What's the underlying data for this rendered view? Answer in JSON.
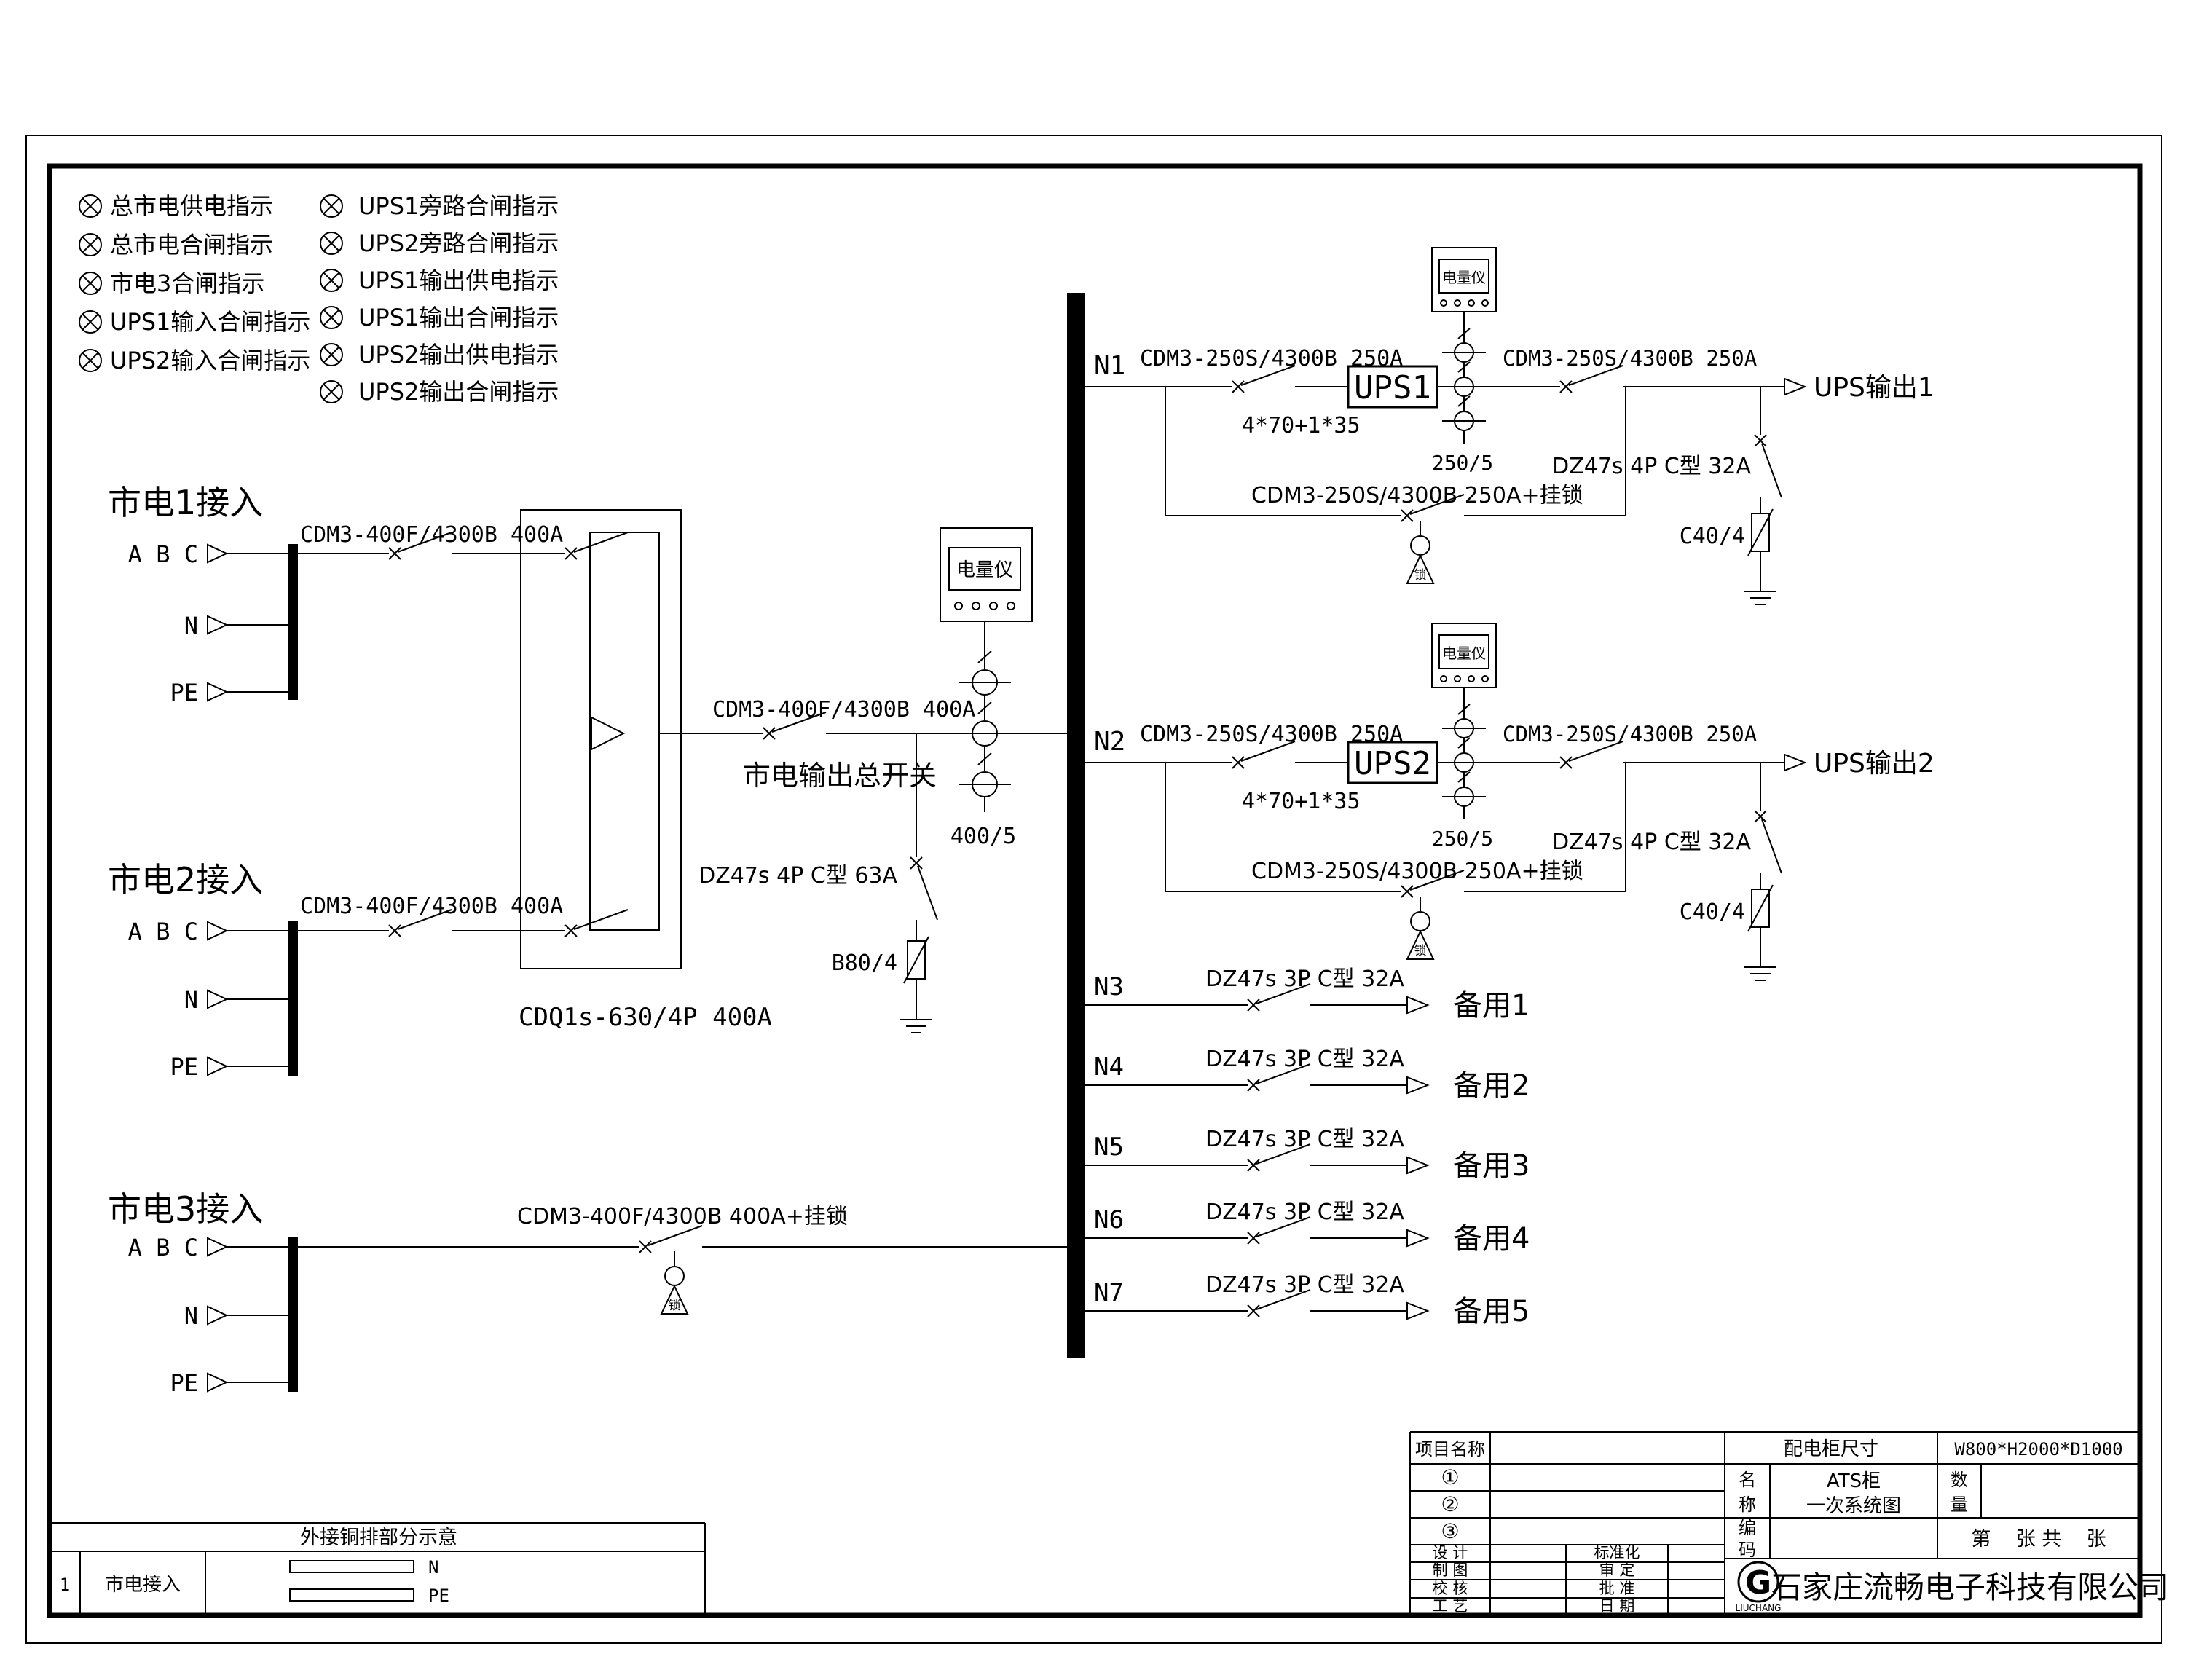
{
  "legend": {
    "items_col1": [
      "总市电供电指示",
      "总市电合闸指示",
      "市电3合闸指示",
      "UPS1输入合闸指示",
      "UPS2输入合闸指示"
    ],
    "items_col2": [
      "UPS1旁路合闸指示",
      "UPS2旁路合闸指示",
      "UPS1输出供电指示",
      "UPS1输出合闸指示",
      "UPS2输出供电指示",
      "UPS2输出合闸指示"
    ]
  },
  "sources": [
    {
      "title": "市电1接入",
      "breaker_label": "CDM3-400F/4300B 400A",
      "terminal_abc": "A B C",
      "terminal_n": "N",
      "terminal_pe": "PE"
    },
    {
      "title": "市电2接入",
      "breaker_label": "CDM3-400F/4300B 400A",
      "terminal_abc": "A B C",
      "terminal_n": "N",
      "terminal_pe": "PE"
    },
    {
      "title": "市电3接入",
      "breaker_label": "CDM3-400F/4300B 400A+挂锁",
      "lock_char": "锁",
      "terminal_abc": "A B C",
      "terminal_n": "N",
      "terminal_pe": "PE"
    }
  ],
  "ats": {
    "model_label": "CDQ1s-630/4P 400A"
  },
  "main_output": {
    "breaker_label": "CDM3-400F/4300B 400A",
    "switch_name": "市电输出总开关",
    "meter_label": "电量仪",
    "ct_ratio": "400/5",
    "spd_breaker_label": "DZ47s 4P C型 63A",
    "spd_label": "B80/4"
  },
  "ups_feeders": [
    {
      "id": "N1",
      "input_breaker": "CDM3-250S/4300B 250A",
      "cable": "4*70+1*35",
      "ups_label": "UPS1",
      "meter_label": "电量仪",
      "ct_ratio": "250/5",
      "output_breaker": "CDM3-250S/4300B 250A",
      "bypass_breaker": "CDM3-250S/4300B 250A+挂锁",
      "lock_char": "锁",
      "spd_breaker_label": "DZ47s 4P C型 32A",
      "spd_label": "C40/4",
      "output_label": "UPS输出1"
    },
    {
      "id": "N2",
      "input_breaker": "CDM3-250S/4300B 250A",
      "cable": "4*70+1*35",
      "ups_label": "UPS2",
      "meter_label": "电量仪",
      "ct_ratio": "250/5",
      "output_breaker": "CDM3-250S/4300B 250A",
      "bypass_breaker": "CDM3-250S/4300B 250A+挂锁",
      "lock_char": "锁",
      "spd_breaker_label": "DZ47s 4P C型 32A",
      "spd_label": "C40/4",
      "output_label": "UPS输出2"
    }
  ],
  "spare_feeders": [
    {
      "id": "N3",
      "breaker_label": "DZ47s 3P C型 32A",
      "output_label": "备用1"
    },
    {
      "id": "N4",
      "breaker_label": "DZ47s 3P C型 32A",
      "output_label": "备用2"
    },
    {
      "id": "N5",
      "breaker_label": "DZ47s 3P C型 32A",
      "output_label": "备用3"
    },
    {
      "id": "N6",
      "breaker_label": "DZ47s 3P C型 32A",
      "output_label": "备用4"
    },
    {
      "id": "N7",
      "breaker_label": "DZ47s 3P C型 32A",
      "output_label": "备用5"
    }
  ],
  "external_busbar_table": {
    "title": "外接铜排部分示意",
    "row_no": "1",
    "row_label": "市电接入",
    "bar1_label": "N",
    "bar2_label": "PE"
  },
  "title_block": {
    "project_label": "项目名称",
    "cabinet_size_label": "配电柜尺寸",
    "cabinet_size_value": "W800*H2000*D1000",
    "row1_no": "①",
    "row2_no": "②",
    "row3_no": "③",
    "name_label_1": "名",
    "name_label_2": "称",
    "name_value_line1": "ATS柜",
    "name_value_line2": "一次系统图",
    "qty_label_1": "数",
    "qty_label_2": "量",
    "code_label_1": "编",
    "code_label_2": "码",
    "sheet_text": "第    张 共    张",
    "design_label": "设 计",
    "standard_label": "标准化",
    "draft_label": "制 图",
    "review_label": "审 定",
    "check_label": "校 核",
    "approve_label": "批 准",
    "process_label": "工 艺",
    "date_label": "日 期",
    "company_name": "石家庄流畅电子科技有限公司",
    "logo_letter": "G",
    "logo_text": "LIUCHANG"
  }
}
